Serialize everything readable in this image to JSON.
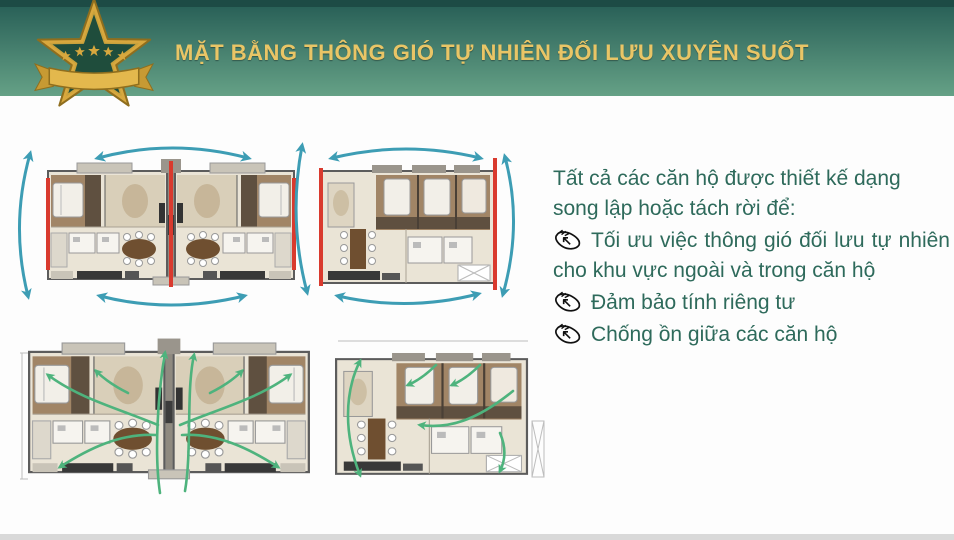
{
  "header": {
    "title": "MẶT BẰNG THÔNG GIÓ TỰ NHIÊN ĐỐI LƯU XUYÊN SUỐT",
    "badge": "gold-five-star-ribbon-badge"
  },
  "content": {
    "intro_line1": "Tất cả các căn hộ được thiết kế dạng",
    "intro_line2": "song lập hoặc tách rời để:",
    "bullets": [
      {
        "icon": "pointing-hand-icon",
        "text": "Tối ưu việc thông gió đối lưu tự nhiên cho khu vực ngoài và trong căn hộ"
      },
      {
        "icon": "pointing-hand-icon",
        "text": "Đảm bảo tính riêng tư"
      },
      {
        "icon": "pointing-hand-icon",
        "text": "Chống ồn giữa các căn hộ"
      }
    ]
  },
  "diagrams": {
    "top_left": "twin-apartment-floor-plan-with-cross-ventilation-arcs",
    "top_right": "single-apartment-floor-plan-with-cross-ventilation-arcs",
    "bottom_left": "twin-apartment-floor-plan-with-airflow-paths",
    "bottom_right": "single-apartment-floor-plan-with-airflow-paths"
  },
  "colors": {
    "header-top-strip": "#1d4b45",
    "header-grad-top": "#2a6158",
    "header-grad-bottom": "#65a186",
    "title-gold": "#e9c566",
    "badge-gold": "#d8a83e",
    "badge-gold-dark": "#8f6e1e",
    "badge-green": "#1f4d3c",
    "text-green": "#2e6a5b",
    "arrow-teal": "#3d9db4",
    "arrow-green": "#4eb37d",
    "accent-red": "#d93a2e",
    "plan-wall": "#5c5c5c",
    "plan-floor": "#eae4d6",
    "plan-brown": "#a18566",
    "plan-brown-dark": "#5f5040",
    "plan-tan": "#d9cfb9",
    "plan-gray": "#c9c4b8",
    "plan-dark": "#383838",
    "table-brown": "#6f4f30",
    "bottom-strip": "#d9d9d9"
  }
}
